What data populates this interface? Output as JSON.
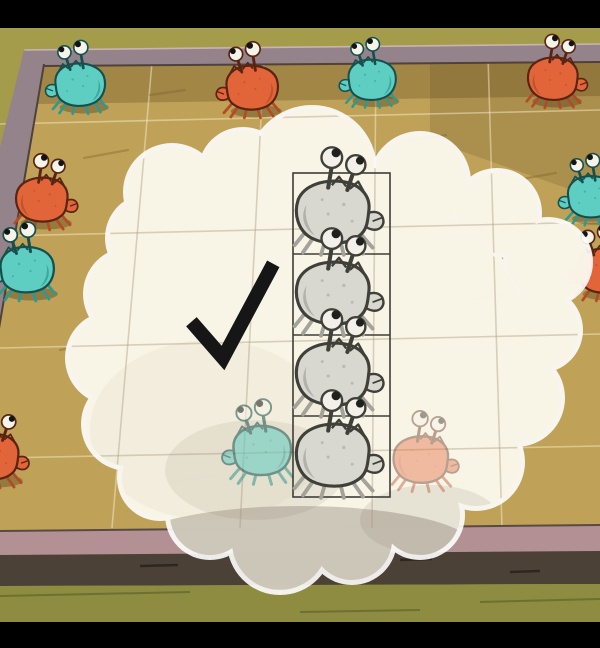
{
  "colors": {
    "letterbox": "#000000",
    "floor_top": "#a49c4b",
    "floor_bottom": "#8d8c41",
    "wood": "#bfa258",
    "rail": "#94838a",
    "rail_light": "#c9b4b0",
    "rail_dark": "#50413c",
    "frame_front": "#b29094",
    "frame_front_dark": "#5a4a45",
    "table_edge": "#4c4136",
    "crab_shadow": "rgba(55,40,15,0.32)"
  },
  "palettes": {
    "teal": {
      "main": "#5fcec2",
      "dark": "#2e9a8f",
      "outline": "#16504e",
      "eye": "#f6f3e8",
      "pupil": "#141414"
    },
    "orange": {
      "main": "#e2653a",
      "dark": "#b54a24",
      "outline": "#5a2412",
      "eye": "#f6f3e8",
      "pupil": "#141414"
    },
    "grey": {
      "main": "#d8d8d1",
      "dark": "#a3a39b",
      "outline": "#40403a",
      "eye": "#f2f0e8",
      "pupil": "#20201e"
    }
  },
  "board": {
    "grid": {
      "color": "rgba(246,236,200,0.5)",
      "inner_color": "rgba(165,150,120,0.4)",
      "width": 1.6,
      "horizontal": [
        [
          0,
          124,
          600,
          110
        ],
        [
          0,
          236,
          600,
          222
        ],
        [
          0,
          348,
          600,
          334
        ],
        [
          0,
          458,
          600,
          446
        ]
      ],
      "vertical": [
        [
          152,
          62,
          112,
          528
        ],
        [
          264,
          60,
          240,
          528
        ],
        [
          376,
          58,
          372,
          528
        ],
        [
          488,
          56,
          502,
          528
        ]
      ]
    },
    "streak_color": "rgba(120,92,40,0.35)",
    "streaks": [
      [
        84,
        158,
        128,
        150
      ],
      [
        300,
        392,
        346,
        384
      ],
      [
        468,
        300,
        512,
        292
      ],
      [
        174,
        482,
        216,
        475
      ],
      [
        516,
        180,
        556,
        173
      ],
      [
        60,
        350,
        92,
        344
      ],
      [
        404,
        142,
        446,
        135
      ],
      [
        150,
        95,
        185,
        90
      ]
    ]
  },
  "bands": {
    "dark_streak_color": "#2e2720",
    "dark_streaks": [
      [
        140,
        566,
        178,
        565
      ],
      [
        400,
        560,
        432,
        559
      ],
      [
        510,
        572,
        540,
        571
      ]
    ],
    "olive_streak_color": "#6d7031",
    "olive_streaks": [
      [
        0,
        596,
        190,
        592
      ],
      [
        480,
        602,
        600,
        599
      ],
      [
        300,
        612,
        420,
        610
      ]
    ]
  },
  "bubble": {
    "rim_fill": "#ffffff",
    "rim_opacity": 0.9,
    "rim_grow": 5,
    "fill": "#f9f4e6",
    "fill_opacity": 0.9,
    "circles": [
      [
        172,
        192,
        44
      ],
      [
        243,
        172,
        40
      ],
      [
        312,
        170,
        60
      ],
      [
        420,
        182,
        46
      ],
      [
        497,
        213,
        40
      ],
      [
        548,
        262,
        40
      ],
      [
        540,
        330,
        38
      ],
      [
        516,
        398,
        44
      ],
      [
        476,
        462,
        44
      ],
      [
        420,
        515,
        40
      ],
      [
        352,
        540,
        40
      ],
      [
        280,
        542,
        48
      ],
      [
        210,
        515,
        40
      ],
      [
        160,
        478,
        38
      ],
      [
        128,
        424,
        42
      ],
      [
        112,
        358,
        42
      ],
      [
        130,
        294,
        42
      ],
      [
        150,
        238,
        40
      ]
    ],
    "ellipses": [
      [
        318,
        350,
        212,
        168
      ],
      [
        300,
        300,
        180,
        145
      ]
    ],
    "inner_tints": [
      {
        "x": 300,
        "y": 548,
        "rx": 175,
        "ry": 42,
        "o": 0.3,
        "c": "#6b5f52"
      },
      {
        "x": 255,
        "y": 470,
        "rx": 90,
        "ry": 50,
        "o": 0.1,
        "c": "#6b5f52"
      },
      {
        "x": 430,
        "y": 520,
        "rx": 70,
        "ry": 35,
        "o": 0.12,
        "c": "#6b5f52"
      },
      {
        "x": 210,
        "y": 430,
        "rx": 120,
        "ry": 90,
        "o": 0.1,
        "c": "#c9b488"
      }
    ]
  },
  "strip": {
    "x": 293,
    "y": 173,
    "width": 97,
    "height": 324,
    "rows": 4,
    "stroke": "#3e3e38",
    "stroke_width": 1.6
  },
  "checkmark": {
    "points": "196,327 223,358 270,270",
    "color": "#161616",
    "width": 14
  },
  "crabs": [
    {
      "palette": "teal",
      "layer": "board",
      "x": 80,
      "y": 86,
      "scale": 0.82,
      "flip": false
    },
    {
      "palette": "orange",
      "layer": "board",
      "x": 252,
      "y": 89,
      "scale": 0.85,
      "flip": false
    },
    {
      "palette": "teal",
      "layer": "board",
      "x": 372,
      "y": 81,
      "scale": 0.78,
      "flip": false
    },
    {
      "palette": "orange",
      "layer": "board",
      "x": 553,
      "y": 80,
      "scale": 0.82,
      "flip": true
    },
    {
      "palette": "orange",
      "layer": "board",
      "x": 42,
      "y": 201,
      "scale": 0.85,
      "flip": true
    },
    {
      "palette": "teal",
      "layer": "board",
      "x": 27,
      "y": 271,
      "scale": 0.88,
      "flip": false
    },
    {
      "palette": "teal",
      "layer": "board",
      "x": 592,
      "y": 198,
      "scale": 0.8,
      "flip": false
    },
    {
      "palette": "orange",
      "layer": "board",
      "x": 604,
      "y": 272,
      "scale": 0.85,
      "flip": false
    },
    {
      "palette": "orange",
      "layer": "board",
      "x": -8,
      "y": 458,
      "scale": 0.88,
      "flip": true
    },
    {
      "palette": "teal",
      "layer": "faded",
      "x": 262,
      "y": 452,
      "scale": 0.95,
      "flip": false,
      "opacity": 0.55
    },
    {
      "palette": "orange",
      "layer": "faded",
      "x": 421,
      "y": 461,
      "scale": 0.9,
      "flip": true,
      "opacity": 0.4
    },
    {
      "palette": "grey",
      "layer": "strip",
      "x": 333,
      "y": 214,
      "scale": 1.2,
      "flip": true
    },
    {
      "palette": "grey",
      "layer": "strip",
      "x": 333,
      "y": 295,
      "scale": 1.2,
      "flip": true
    },
    {
      "palette": "grey",
      "layer": "strip",
      "x": 333,
      "y": 376,
      "scale": 1.2,
      "flip": true
    },
    {
      "palette": "grey",
      "layer": "strip",
      "x": 333,
      "y": 457,
      "scale": 1.2,
      "flip": true
    }
  ]
}
